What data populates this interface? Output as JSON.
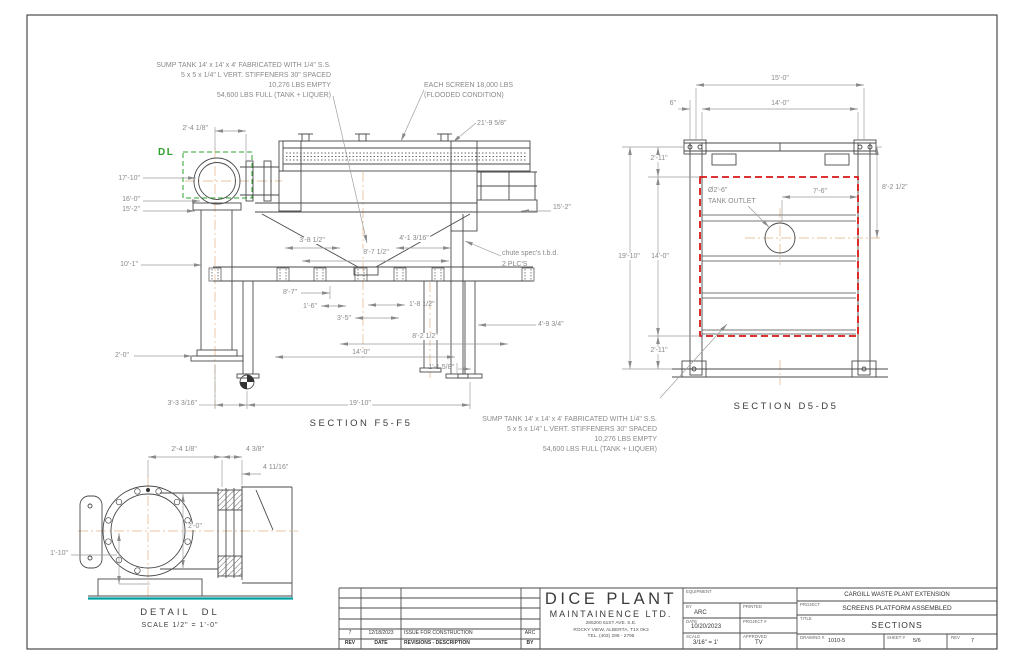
{
  "colors": {
    "line": "#4a4a4a",
    "dim": "#8a8a8a",
    "tank_highlight_red": "#d81616",
    "detail_box_green": "#2ca02c",
    "waterline_teal": "#00a0a0",
    "centerline_orange": "#e3b184"
  },
  "annotations": [
    {
      "n": "note-sump-top-line1",
      "t": "SUMP TANK 14' x 14' x 4' FABRICATED WITH 1/4\" S.S.",
      "x": 331,
      "y": 62,
      "a": "r"
    },
    {
      "n": "note-sump-top-line2",
      "t": "5 x 5 x 1/4\" L VERT. STIFFENERS 30\" SPACED",
      "x": 331,
      "y": 72,
      "a": "r"
    },
    {
      "n": "note-sump-top-line3",
      "t": "10,276 LBS EMPTY",
      "x": 331,
      "y": 82,
      "a": "r"
    },
    {
      "n": "note-sump-top-line4",
      "t": "54,600 LBS FULL (TANK + LIQUER)",
      "x": 331,
      "y": 92,
      "a": "r"
    },
    {
      "n": "note-screen-weight-line1",
      "t": "EACH SCREEN 18,000 LBS",
      "x": 424,
      "y": 82,
      "a": "l"
    },
    {
      "n": "note-screen-weight-line2",
      "t": "(FLOODED CONDITION)",
      "x": 424,
      "y": 92,
      "a": "l"
    },
    {
      "n": "dim-machine-length",
      "t": "21'-9 5/8\"",
      "x": 477,
      "y": 120,
      "a": "l"
    },
    {
      "n": "dim-elbow-offset",
      "t": "2'-4 1/8\"",
      "x": 208,
      "y": 125,
      "a": "r"
    },
    {
      "n": "dim-height-17-10",
      "t": "17'-10\"",
      "x": 140,
      "y": 175,
      "a": "r"
    },
    {
      "n": "dim-height-16-0",
      "t": "16'-0\"",
      "x": 140,
      "y": 196,
      "a": "r"
    },
    {
      "n": "dim-height-15-2",
      "t": "15'-2\"",
      "x": 140,
      "y": 206,
      "a": "r"
    },
    {
      "n": "dim-height-10-1",
      "t": "10'-1\"",
      "x": 138,
      "y": 261,
      "a": "r"
    },
    {
      "n": "dim-flange-2-0",
      "t": "2'-0\"",
      "x": 129,
      "y": 352,
      "a": "r"
    },
    {
      "n": "dim-3-8-half",
      "t": "3'-8 1/2\"",
      "x": 312,
      "y": 237,
      "a": "c",
      "bg": 1
    },
    {
      "n": "dim-8-7-half",
      "t": "8'-7 1/2\"",
      "x": 376,
      "y": 249,
      "a": "c",
      "bg": 1
    },
    {
      "n": "dim-4-1-316",
      "t": "4'-1 3/16\"",
      "x": 414,
      "y": 235,
      "a": "c",
      "bg": 1
    },
    {
      "n": "dim-8-7",
      "t": "8'-7\"",
      "x": 297,
      "y": 289,
      "a": "r"
    },
    {
      "n": "dim-1-6",
      "t": "1'-6\"",
      "x": 317,
      "y": 303,
      "a": "r"
    },
    {
      "n": "dim-3-5",
      "t": "3'-5\"",
      "x": 351,
      "y": 315,
      "a": "r"
    },
    {
      "n": "dim-1-8-half",
      "t": "1'-8 1/2\"",
      "x": 409,
      "y": 301,
      "a": "l"
    },
    {
      "n": "dim-8-2-half-f5",
      "t": "8'-2 1/2\"",
      "x": 425,
      "y": 333,
      "a": "c",
      "bg": 1
    },
    {
      "n": "dim-14-0-f5",
      "t": "14'-0\"",
      "x": 361,
      "y": 349,
      "a": "c",
      "bg": 1
    },
    {
      "n": "dim-1-1-58",
      "t": "1'-1 5/8\"",
      "x": 454,
      "y": 364,
      "a": "r"
    },
    {
      "n": "dim-3-3-316",
      "t": "3'-3 3/16\"",
      "x": 197,
      "y": 400,
      "a": "r"
    },
    {
      "n": "dim-19-10-f5",
      "t": "19'-10\"",
      "x": 360,
      "y": 400,
      "a": "c",
      "bg": 1
    },
    {
      "n": "dim-15-2-right",
      "t": "15'-2\"",
      "x": 553,
      "y": 204,
      "a": "l"
    },
    {
      "n": "note-chute-line1",
      "t": "chute spec's t.b.d.",
      "x": 502,
      "y": 250,
      "a": "l"
    },
    {
      "n": "note-chute-line2",
      "t": "2 PLC'S",
      "x": 502,
      "y": 261,
      "a": "l"
    },
    {
      "n": "dim-4-9-34",
      "t": "4'-9 3/4\"",
      "x": 538,
      "y": 321,
      "a": "l"
    },
    {
      "n": "detail-ref-dl",
      "t": "DL",
      "x": 158,
      "y": 148,
      "a": "l",
      "c": "#2ca02c",
      "s": 10,
      "b": 1,
      "ls": 1.5
    },
    {
      "n": "title-section-f5",
      "t": "SECTION F5-F5",
      "x": 361,
      "y": 419,
      "a": "c",
      "c": "#3c3c3c",
      "s": 9.5,
      "ls": 2.5
    },
    {
      "n": "dim-d5-15-0",
      "t": "15'-0\"",
      "x": 780,
      "y": 75,
      "a": "c",
      "bg": 1
    },
    {
      "n": "dim-d5-6in",
      "t": "6\"",
      "x": 676,
      "y": 100,
      "a": "r"
    },
    {
      "n": "dim-d5-14-0-top",
      "t": "14'-0\"",
      "x": 780,
      "y": 100,
      "a": "c",
      "bg": 1
    },
    {
      "n": "dim-d5-2-11-top",
      "t": "2'-11\"",
      "x": 659,
      "y": 155,
      "a": "c",
      "bg": 1
    },
    {
      "n": "dim-d5-8-2-half",
      "t": "8'-2 1/2\"",
      "x": 882,
      "y": 184,
      "a": "l"
    },
    {
      "n": "note-tank-outlet-line1",
      "t": "Ø2'-6\"",
      "x": 708,
      "y": 187,
      "a": "l"
    },
    {
      "n": "note-tank-outlet-line2",
      "t": "TANK OUTLET",
      "x": 708,
      "y": 198,
      "a": "l"
    },
    {
      "n": "dim-d5-7-6",
      "t": "7'-6\"",
      "x": 820,
      "y": 188,
      "a": "c",
      "bg": 1
    },
    {
      "n": "dim-d5-19-10",
      "t": "19'-10\"",
      "x": 629,
      "y": 253,
      "a": "c",
      "bg": 1
    },
    {
      "n": "dim-d5-14-0-left",
      "t": "14'-0\"",
      "x": 660,
      "y": 253,
      "a": "c",
      "bg": 1
    },
    {
      "n": "dim-d5-2-11-bottom",
      "t": "2'-11\"",
      "x": 659,
      "y": 347,
      "a": "c",
      "bg": 1
    },
    {
      "n": "title-section-d5",
      "t": "SECTION D5-D5",
      "x": 786,
      "y": 402,
      "a": "c",
      "c": "#3c3c3c",
      "s": 9.5,
      "ls": 2.5
    },
    {
      "n": "note-sump-bottom-line1",
      "t": "SUMP TANK 14' x 14' x 4' FABRICATED WITH 1/4\" S.S.",
      "x": 657,
      "y": 416,
      "a": "r"
    },
    {
      "n": "note-sump-bottom-line2",
      "t": "5 x 5 x 1/4\" L VERT. STIFFENERS 30\" SPACED",
      "x": 657,
      "y": 426,
      "a": "r"
    },
    {
      "n": "note-sump-bottom-line3",
      "t": "10,276 LBS EMPTY",
      "x": 657,
      "y": 436,
      "a": "r"
    },
    {
      "n": "note-sump-bottom-line4",
      "t": "54,600 LBS FULL (TANK + LIQUER)",
      "x": 657,
      "y": 446,
      "a": "r"
    },
    {
      "n": "dim-dl-2-4-18",
      "t": "2'-4 1/8\"",
      "x": 184,
      "y": 446,
      "a": "c",
      "bg": 1
    },
    {
      "n": "dim-dl-4-38",
      "t": "4 3/8\"",
      "x": 246,
      "y": 446,
      "a": "l"
    },
    {
      "n": "dim-dl-4-1116",
      "t": "4 11/16\"",
      "x": 263,
      "y": 464,
      "a": "l"
    },
    {
      "n": "dim-dl-2-0",
      "t": "2'-0\"",
      "x": 187,
      "y": 523,
      "a": "l",
      "bg": 1
    },
    {
      "n": "dim-dl-1-10",
      "t": "1'-10\"",
      "x": 68,
      "y": 550,
      "a": "r"
    },
    {
      "n": "title-detail-dl",
      "t": "DETAIL  DL",
      "x": 180,
      "y": 608,
      "a": "c",
      "c": "#3c3c3c",
      "s": 9.5,
      "ls": 3
    },
    {
      "n": "title-detail-dl-scale",
      "t": "SCALE 1/2\" = 1'-0\"",
      "x": 180,
      "y": 622,
      "a": "c",
      "c": "#3c3c3c",
      "s": 7,
      "ls": 1
    }
  ],
  "titleblock": {
    "rev_table": {
      "headers": [
        "REV",
        "DATE",
        "REVISIONS - DESCRIPTION",
        "BY"
      ],
      "rows": [
        {
          "rev": "7",
          "date": "12/18/2023",
          "desc": "ISSUE FOR CONSTRUCTION",
          "by": "ARC"
        }
      ]
    },
    "company": {
      "name_line1": "DICE PLANT",
      "name_line2": "MAINTAINENCE LTD.",
      "address1": "285200 61ST AVE. S.E.",
      "address2": "ROCKY VIEW, ALBERTA, T1X 0K3",
      "address3": "TEL. (403) 286 - 2795"
    },
    "fields": {
      "equipment_label": "EQUIPMENT",
      "by_label": "BY",
      "by_value": "ARC",
      "printed_label": "PRINTED",
      "date_label": "DATE",
      "date_value": "10/20/2023",
      "project_no_label": "PROJECT #",
      "scale_label": "SCALE",
      "scale_value": "3/16\" = 1'",
      "approved_label": "APPROVED",
      "approved_value": "TV"
    },
    "project": {
      "client": "CARGILL WASTE PLANT EXTENSION",
      "project_label": "PROJECT",
      "project_value": "SCREENS PLATFORM ASSEMBLED",
      "title_label": "TITLE",
      "title_value": "SECTIONS",
      "drawing_no_label": "DRAWING #.",
      "drawing_no": "1010-5",
      "sheet_label": "SHEET #",
      "sheet": "5/6",
      "rev_label": "REV",
      "rev": "7"
    }
  }
}
